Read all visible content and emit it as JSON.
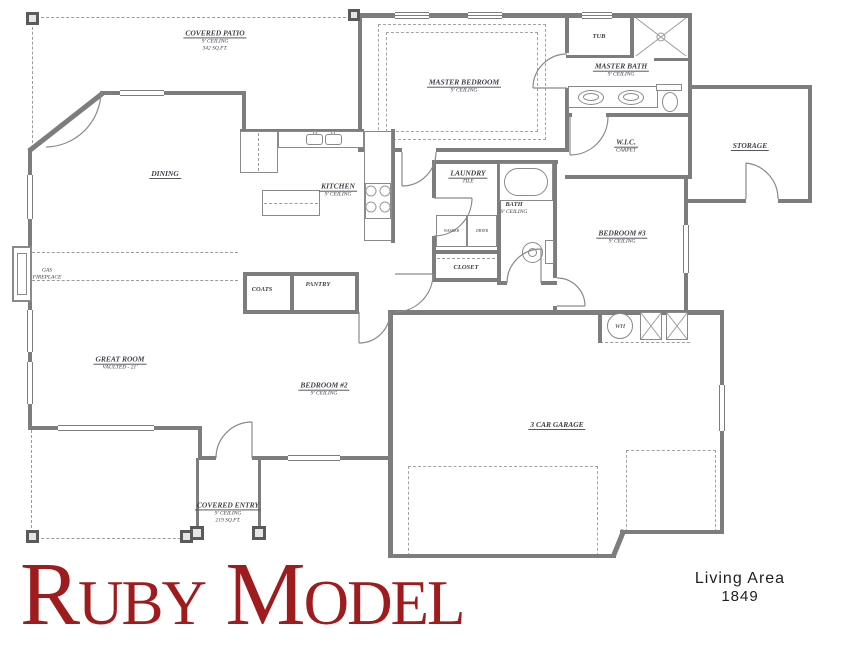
{
  "title": "Ruby Model",
  "colors": {
    "title": "#9e1b1e",
    "wall": "#7d7d7d",
    "label": "#3f4147",
    "dash": "#9b9b9b"
  },
  "footer": {
    "living_area_label": "Living Area",
    "living_area_value": "1849"
  },
  "labels": {
    "covered_patio": {
      "name": "COVERED PATIO",
      "ceiling": "9' CEILING",
      "area": "342 SQ.FT."
    },
    "master_bedroom": {
      "name": "MASTER BEDROOM",
      "ceiling": "9' CEILING"
    },
    "tub": "TUB",
    "master_bath": {
      "name": "MASTER BATH",
      "ceiling": "9' CEILING"
    },
    "wic": {
      "name": "W.I.C.",
      "floor": "CARPET"
    },
    "storage": {
      "name": "STORAGE"
    },
    "dining": {
      "name": "DINING"
    },
    "kitchen": {
      "name": "KITCHEN",
      "ceiling": "9' CEILING"
    },
    "laundry": {
      "name": "LAUNDRY",
      "floor": "TILE"
    },
    "washer": "WASHER",
    "dryer": "DRYER",
    "closet": "CLOSET",
    "bath": {
      "name": "BATH",
      "ceiling": "9' CEILING"
    },
    "bedroom3": {
      "name": "BEDROOM #3",
      "ceiling": "9' CEILING"
    },
    "gas_fireplace": {
      "line1": "GAS",
      "line2": "FIREPLACE"
    },
    "great_room": {
      "name": "GREAT ROOM",
      "ceiling": "VAULTED - 21'"
    },
    "coats": "COATS",
    "pantry": "PANTRY",
    "bedroom2": {
      "name": "BEDROOM #2",
      "ceiling": "9' CEILING"
    },
    "garage": {
      "name": "3 CAR GARAGE"
    },
    "covered_entry": {
      "name": "COVERED ENTRY",
      "ceiling": "9' CEILING",
      "area": "219 SQ.FT."
    },
    "water_heater": "WH"
  }
}
